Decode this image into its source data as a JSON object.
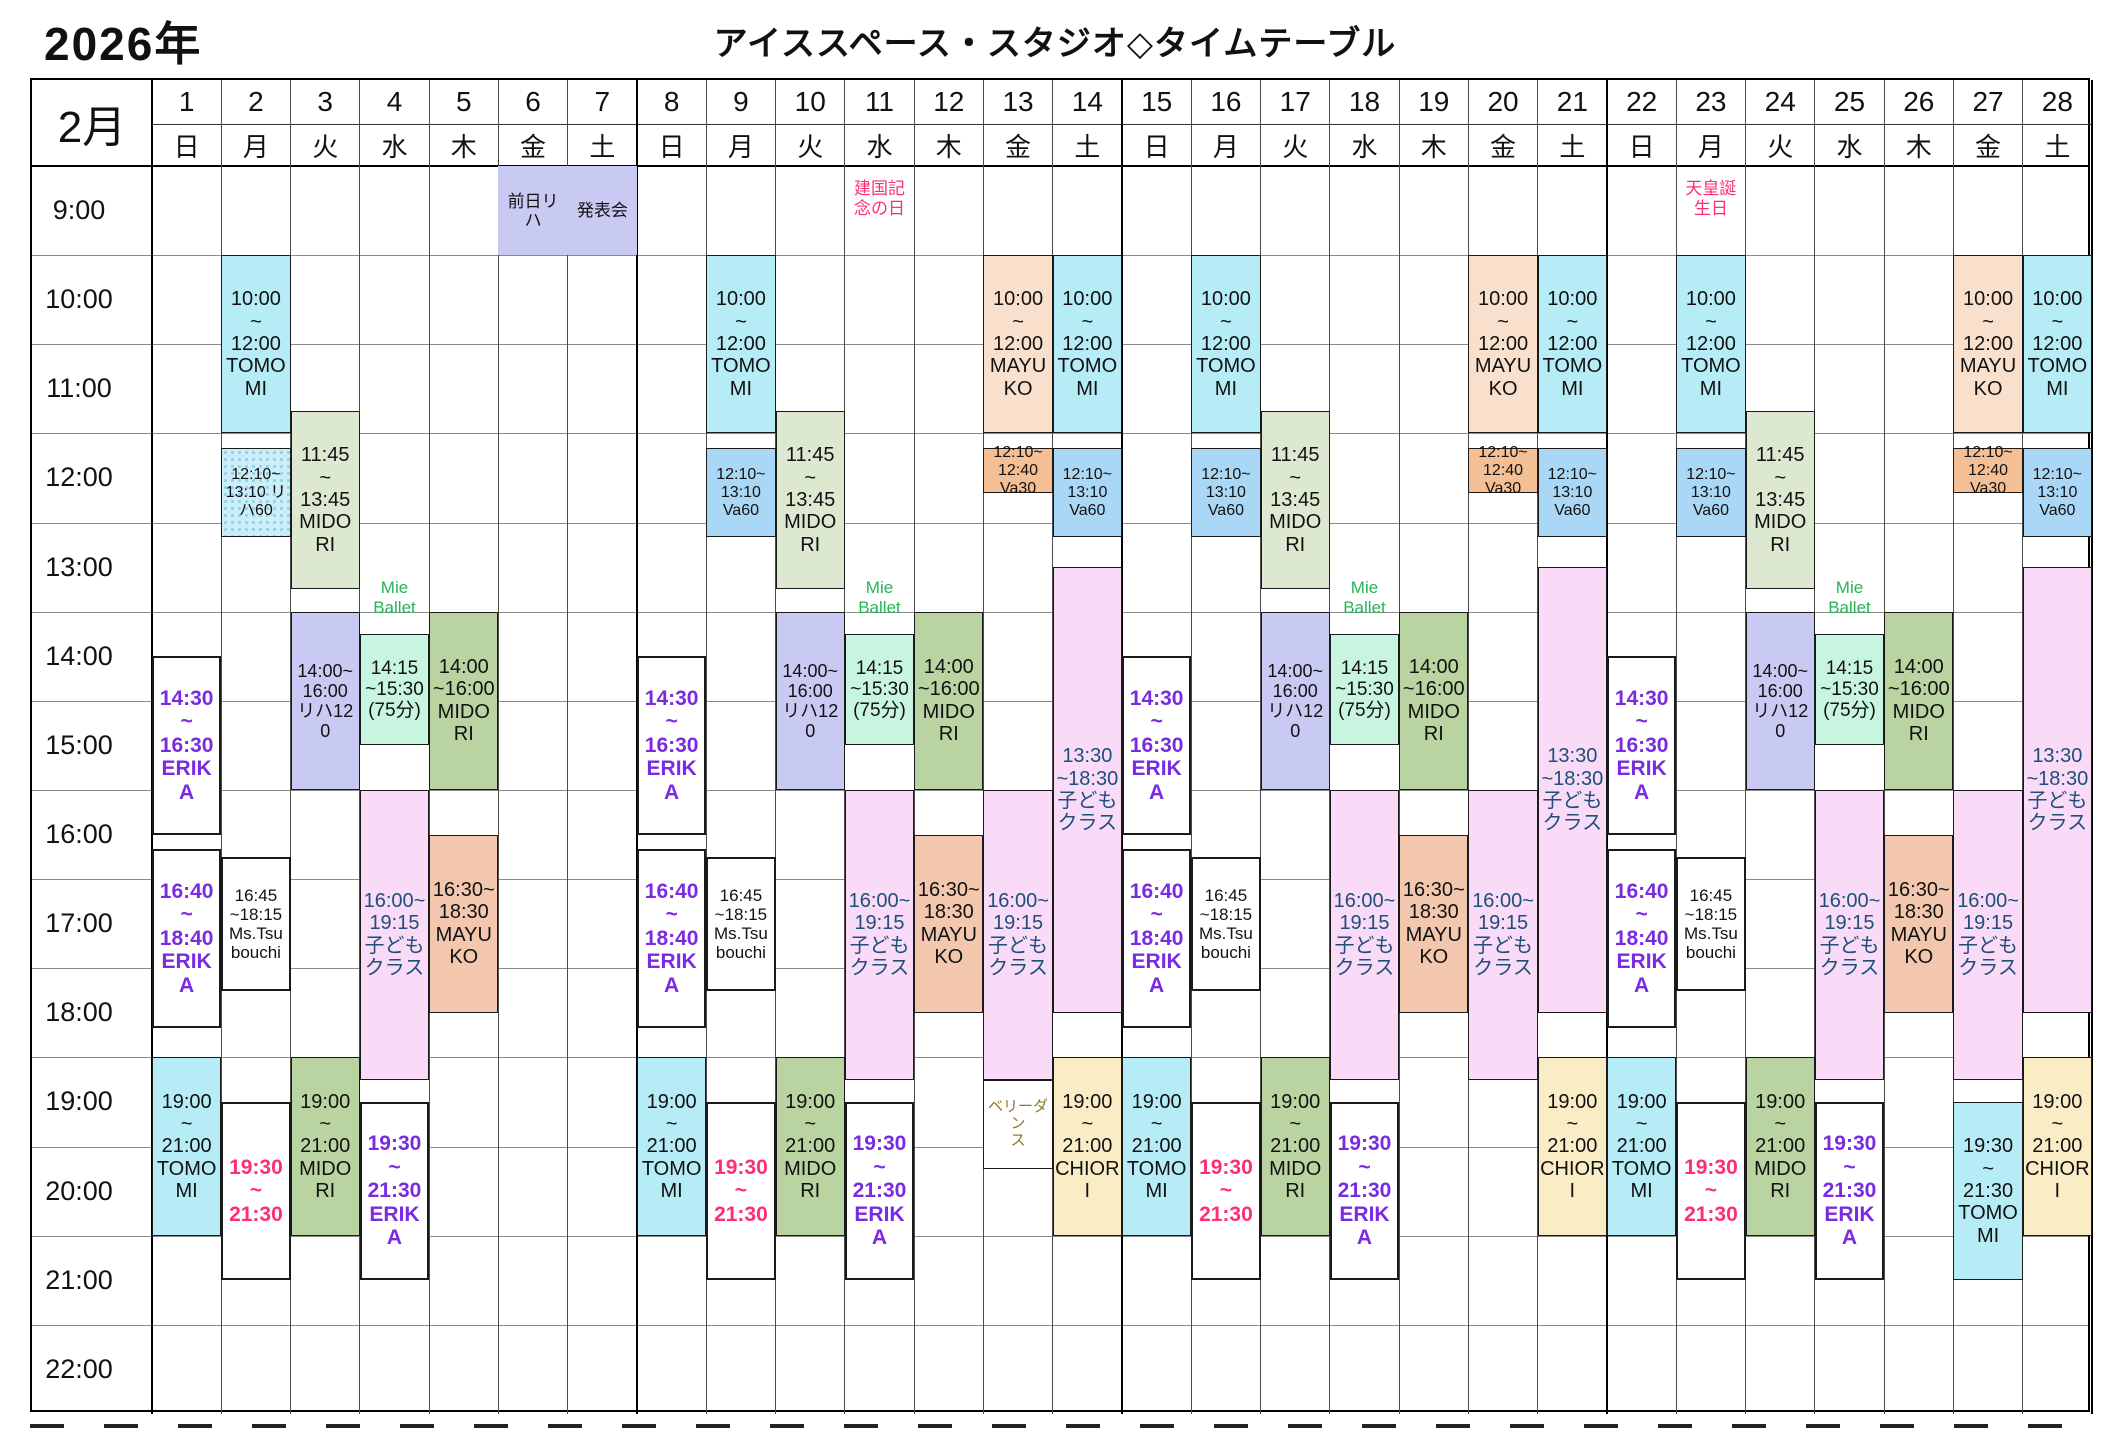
{
  "page": {
    "year_label": "2026年",
    "title": "アイススペース・スタジオ◇タイムテーブル"
  },
  "calendar": {
    "month_label": "2月",
    "time_labels": [
      "9:00",
      "10:00",
      "11:00",
      "12:00",
      "13:00",
      "14:00",
      "15:00",
      "16:00",
      "17:00",
      "18:00",
      "19:00",
      "20:00",
      "21:00",
      "22:00"
    ],
    "days": [
      {
        "num": "1",
        "weekday": "日"
      },
      {
        "num": "2",
        "weekday": "月"
      },
      {
        "num": "3",
        "weekday": "火"
      },
      {
        "num": "4",
        "weekday": "水"
      },
      {
        "num": "5",
        "weekday": "木"
      },
      {
        "num": "6",
        "weekday": "金"
      },
      {
        "num": "7",
        "weekday": "土"
      },
      {
        "num": "8",
        "weekday": "日"
      },
      {
        "num": "9",
        "weekday": "月"
      },
      {
        "num": "10",
        "weekday": "火"
      },
      {
        "num": "11",
        "weekday": "水"
      },
      {
        "num": "12",
        "weekday": "木"
      },
      {
        "num": "13",
        "weekday": "金"
      },
      {
        "num": "14",
        "weekday": "土"
      },
      {
        "num": "15",
        "weekday": "日"
      },
      {
        "num": "16",
        "weekday": "月"
      },
      {
        "num": "17",
        "weekday": "火"
      },
      {
        "num": "18",
        "weekday": "水"
      },
      {
        "num": "19",
        "weekday": "木"
      },
      {
        "num": "20",
        "weekday": "金"
      },
      {
        "num": "21",
        "weekday": "土"
      },
      {
        "num": "22",
        "weekday": "日"
      },
      {
        "num": "23",
        "weekday": "月"
      },
      {
        "num": "24",
        "weekday": "火"
      },
      {
        "num": "25",
        "weekday": "水"
      },
      {
        "num": "26",
        "weekday": "木"
      },
      {
        "num": "27",
        "weekday": "金"
      },
      {
        "num": "28",
        "weekday": "土"
      }
    ],
    "holidays": [
      {
        "day": 11,
        "text": "建国記\n念の日"
      },
      {
        "day": 23,
        "text": "天皇誕\n生日"
      }
    ],
    "floating_labels": [
      {
        "day": 4,
        "text": "Mie\nBallet"
      },
      {
        "day": 11,
        "text": "Mie\nBallet"
      },
      {
        "day": 18,
        "text": "Mie\nBallet"
      },
      {
        "day": 25,
        "text": "Mie\nBallet"
      }
    ],
    "styles": {
      "cyan": {
        "bg": "#b5ecf6",
        "fg": "#111111",
        "borderW": 1.5,
        "size": 20
      },
      "va60": {
        "bg": "#a9d7f5",
        "fg": "#111111",
        "borderW": 1.5,
        "size": 16
      },
      "riha60": {
        "bg": "#cdeef8",
        "fg": "#111111",
        "borderW": 1.5,
        "size": 16,
        "dots": true
      },
      "va30": {
        "bg": "#f4bf95",
        "fg": "#111111",
        "borderW": 1.5,
        "size": 16
      },
      "peach": {
        "bg": "#f9e0cc",
        "fg": "#111111",
        "borderW": 1.5,
        "size": 20
      },
      "salmon": {
        "bg": "#f2c7ad",
        "fg": "#111111",
        "borderW": 1.5,
        "size": 20
      },
      "sage": {
        "bg": "#dde8d1",
        "fg": "#111111",
        "borderW": 1.5,
        "size": 20
      },
      "green": {
        "bg": "#b9d3a1",
        "fg": "#111111",
        "borderW": 1.5,
        "size": 20
      },
      "mint": {
        "bg": "#c8f5df",
        "fg": "#111111",
        "borderW": 1.5,
        "size": 19
      },
      "lavender": {
        "bg": "#c9caf3",
        "fg": "#111111",
        "borderW": 1.5,
        "size": 18
      },
      "lavender_plain": {
        "bg": "#c9caf3",
        "fg": "#111111",
        "borderW": 0,
        "size": 17
      },
      "pink": {
        "bg": "#f9dbf7",
        "fg": "#1e4e79",
        "borderW": 1.5,
        "size": 20
      },
      "cream": {
        "bg": "#faecc5",
        "fg": "#111111",
        "borderW": 1.5,
        "size": 20
      },
      "white_purple": {
        "bg": "#ffffff",
        "fg": "#7a2be2",
        "borderW": 2,
        "size": 21,
        "bold": true
      },
      "white_red": {
        "bg": "#ffffff",
        "fg": "#ff2d78",
        "borderW": 2,
        "size": 21,
        "bold": true
      },
      "white_black": {
        "bg": "#ffffff",
        "fg": "#111111",
        "borderW": 2,
        "size": 17
      },
      "white_gold": {
        "bg": "#ffffff",
        "fg": "#8f7a1c",
        "borderW": 1.5,
        "size": 15
      }
    },
    "holiday_color": "#ff2d78",
    "floating_label_color": "#27b357",
    "events": [
      {
        "day": 1,
        "start": 14.5,
        "end": 16.5,
        "style": "white_purple",
        "text": "14:30\n~\n16:30\nERIKA"
      },
      {
        "day": 1,
        "start": 16.667,
        "end": 18.667,
        "style": "white_purple",
        "text": "16:40\n~\n18:40\nERIKA"
      },
      {
        "day": 1,
        "start": 19,
        "end": 21,
        "style": "cyan",
        "text": "19:00\n~\n21:00\nTOMO\nMI"
      },
      {
        "day": 2,
        "start": 10,
        "end": 12,
        "style": "cyan",
        "text": "10:00\n~\n12:00\nTOMO\nMI"
      },
      {
        "day": 2,
        "start": 12.167,
        "end": 13.167,
        "style": "riha60",
        "text": "12:10~\n13:10 リハ60"
      },
      {
        "day": 2,
        "start": 16.75,
        "end": 18.25,
        "style": "white_black",
        "text": "16:45\n~18:15\nMs.Tsu\nbouchi"
      },
      {
        "day": 2,
        "start": 19.5,
        "end": 21.5,
        "style": "white_red",
        "text": "19:30\n~\n21:30"
      },
      {
        "day": 3,
        "start": 11.75,
        "end": 13.75,
        "style": "sage",
        "text": "11:45\n~\n13:45\nMIDO\nRI"
      },
      {
        "day": 3,
        "start": 14,
        "end": 16,
        "style": "lavender",
        "text": "14:00~\n16:00\nリハ120"
      },
      {
        "day": 3,
        "start": 19,
        "end": 21,
        "style": "green",
        "text": "19:00\n~\n21:00\nMIDO\nRI"
      },
      {
        "day": 4,
        "start": 14.25,
        "end": 15.5,
        "style": "mint",
        "text": "14:15\n~15:30(75分)"
      },
      {
        "day": 4,
        "start": 16,
        "end": 19.25,
        "style": "pink",
        "text": "16:00~\n19:15\n子ども\nクラス"
      },
      {
        "day": 4,
        "start": 19.5,
        "end": 21.5,
        "style": "white_purple",
        "text": "19:30\n~\n21:30\nERIK\nA"
      },
      {
        "day": 5,
        "start": 14,
        "end": 16,
        "style": "green",
        "text": "14:00\n~16:00\nMIDO\nRI"
      },
      {
        "day": 5,
        "start": 16.5,
        "end": 18.5,
        "style": "salmon",
        "text": "16:30~\n18:30\nMAYU\nKO"
      },
      {
        "day": 6,
        "start": 9,
        "end": 10,
        "style": "lavender_plain",
        "text": "前日リ\nハ"
      },
      {
        "day": 7,
        "start": 9,
        "end": 10,
        "style": "lavender_plain",
        "text": "発表会"
      },
      {
        "day": 8,
        "start": 14.5,
        "end": 16.5,
        "style": "white_purple",
        "text": "14:30\n~\n16:30\nERIKA"
      },
      {
        "day": 8,
        "start": 16.667,
        "end": 18.667,
        "style": "white_purple",
        "text": "16:40\n~\n18:40\nERIKA"
      },
      {
        "day": 8,
        "start": 19,
        "end": 21,
        "style": "cyan",
        "text": "19:00\n~\n21:00\nTOMO\nMI"
      },
      {
        "day": 9,
        "start": 10,
        "end": 12,
        "style": "cyan",
        "text": "10:00\n~\n12:00\nTOMO\nMI"
      },
      {
        "day": 9,
        "start": 12.167,
        "end": 13.167,
        "style": "va60",
        "text": "12:10~\n13:10\nVa60"
      },
      {
        "day": 9,
        "start": 16.75,
        "end": 18.25,
        "style": "white_black",
        "text": "16:45\n~18:15\nMs.Tsu\nbouchi"
      },
      {
        "day": 9,
        "start": 19.5,
        "end": 21.5,
        "style": "white_red",
        "text": "19:30\n~\n21:30"
      },
      {
        "day": 10,
        "start": 11.75,
        "end": 13.75,
        "style": "sage",
        "text": "11:45\n~\n13:45\nMIDO\nRI"
      },
      {
        "day": 10,
        "start": 14,
        "end": 16,
        "style": "lavender",
        "text": "14:00~\n16:00\nリハ120"
      },
      {
        "day": 10,
        "start": 19,
        "end": 21,
        "style": "green",
        "text": "19:00\n~\n21:00\nMIDO\nRI"
      },
      {
        "day": 11,
        "start": 14.25,
        "end": 15.5,
        "style": "mint",
        "text": "14:15\n~15:30(75分)"
      },
      {
        "day": 11,
        "start": 16,
        "end": 19.25,
        "style": "pink",
        "text": "16:00~\n19:15\n子ども\nクラス"
      },
      {
        "day": 11,
        "start": 19.5,
        "end": 21.5,
        "style": "white_purple",
        "text": "19:30\n~\n21:30\nERIK\nA"
      },
      {
        "day": 12,
        "start": 14,
        "end": 16,
        "style": "green",
        "text": "14:00\n~16:00\nMIDO\nRI"
      },
      {
        "day": 12,
        "start": 16.5,
        "end": 18.5,
        "style": "salmon",
        "text": "16:30~\n18:30\nMAYU\nKO"
      },
      {
        "day": 13,
        "start": 10,
        "end": 12,
        "style": "peach",
        "text": "10:00\n~\n12:00\nMAYU\nKO"
      },
      {
        "day": 13,
        "start": 12.167,
        "end": 12.667,
        "style": "va30",
        "text": "12:10~\n12:40\nVa30"
      },
      {
        "day": 13,
        "start": 16,
        "end": 19.25,
        "style": "pink",
        "text": "16:00~\n19:15\n子ども\nクラス"
      },
      {
        "day": 13,
        "start": 19.25,
        "end": 20.25,
        "style": "white_gold",
        "text": "ベリーダン\nス"
      },
      {
        "day": 14,
        "start": 10,
        "end": 12,
        "style": "cyan",
        "text": "10:00\n~\n12:00\nTOMO\nMI"
      },
      {
        "day": 14,
        "start": 12.167,
        "end": 13.167,
        "style": "va60",
        "text": "12:10~\n13:10\nVa60"
      },
      {
        "day": 14,
        "start": 13.5,
        "end": 18.5,
        "style": "pink",
        "text": "13:30\n~18:30 子どもクラス"
      },
      {
        "day": 14,
        "start": 19,
        "end": 21,
        "style": "cream",
        "text": "19:00\n~\n21:00\nCHIOR\nI"
      },
      {
        "day": 15,
        "start": 14.5,
        "end": 16.5,
        "style": "white_purple",
        "text": "14:30\n~\n16:30\nERIKA"
      },
      {
        "day": 15,
        "start": 16.667,
        "end": 18.667,
        "style": "white_purple",
        "text": "16:40\n~\n18:40\nERIKA"
      },
      {
        "day": 15,
        "start": 19,
        "end": 21,
        "style": "cyan",
        "text": "19:00\n~\n21:00\nTOMO\nMI"
      },
      {
        "day": 16,
        "start": 10,
        "end": 12,
        "style": "cyan",
        "text": "10:00\n~\n12:00\nTOMO\nMI"
      },
      {
        "day": 16,
        "start": 12.167,
        "end": 13.167,
        "style": "va60",
        "text": "12:10~\n13:10\nVa60"
      },
      {
        "day": 16,
        "start": 16.75,
        "end": 18.25,
        "style": "white_black",
        "text": "16:45\n~18:15\nMs.Tsu\nbouchi"
      },
      {
        "day": 16,
        "start": 19.5,
        "end": 21.5,
        "style": "white_red",
        "text": "19:30\n~\n21:30"
      },
      {
        "day": 17,
        "start": 11.75,
        "end": 13.75,
        "style": "sage",
        "text": "11:45\n~\n13:45\nMIDO\nRI"
      },
      {
        "day": 17,
        "start": 14,
        "end": 16,
        "style": "lavender",
        "text": "14:00~\n16:00\nリハ120"
      },
      {
        "day": 17,
        "start": 19,
        "end": 21,
        "style": "green",
        "text": "19:00\n~\n21:00\nMIDO\nRI"
      },
      {
        "day": 18,
        "start": 14.25,
        "end": 15.5,
        "style": "mint",
        "text": "14:15\n~15:30(75分)"
      },
      {
        "day": 18,
        "start": 16,
        "end": 19.25,
        "style": "pink",
        "text": "16:00~\n19:15\n子ども\nクラス"
      },
      {
        "day": 18,
        "start": 19.5,
        "end": 21.5,
        "style": "white_purple",
        "text": "19:30\n~\n21:30\nERIK\nA"
      },
      {
        "day": 19,
        "start": 14,
        "end": 16,
        "style": "green",
        "text": "14:00\n~16:00\nMIDO\nRI"
      },
      {
        "day": 19,
        "start": 16.5,
        "end": 18.5,
        "style": "salmon",
        "text": "16:30~\n18:30\nMAYU\nKO"
      },
      {
        "day": 20,
        "start": 10,
        "end": 12,
        "style": "peach",
        "text": "10:00\n~\n12:00\nMAYU\nKO"
      },
      {
        "day": 20,
        "start": 12.167,
        "end": 12.667,
        "style": "va30",
        "text": "12:10~\n12:40\nVa30"
      },
      {
        "day": 20,
        "start": 16,
        "end": 19.25,
        "style": "pink",
        "text": "16:00~\n19:15\n子ども\nクラス"
      },
      {
        "day": 21,
        "start": 10,
        "end": 12,
        "style": "cyan",
        "text": "10:00\n~\n12:00\nTOMO\nMI"
      },
      {
        "day": 21,
        "start": 12.167,
        "end": 13.167,
        "style": "va60",
        "text": "12:10~\n13:10\nVa60"
      },
      {
        "day": 21,
        "start": 13.5,
        "end": 18.5,
        "style": "pink",
        "text": "13:30\n~18:30 子どもクラス"
      },
      {
        "day": 21,
        "start": 19,
        "end": 21,
        "style": "cream",
        "text": "19:00\n~\n21:00\nCHIOR\nI"
      },
      {
        "day": 22,
        "start": 14.5,
        "end": 16.5,
        "style": "white_purple",
        "text": "14:30\n~\n16:30\nERIKA"
      },
      {
        "day": 22,
        "start": 16.667,
        "end": 18.667,
        "style": "white_purple",
        "text": "16:40\n~\n18:40\nERIKA"
      },
      {
        "day": 22,
        "start": 19,
        "end": 21,
        "style": "cyan",
        "text": "19:00\n~\n21:00\nTOMO\nMI"
      },
      {
        "day": 23,
        "start": 10,
        "end": 12,
        "style": "cyan",
        "text": "10:00\n~\n12:00\nTOMO\nMI"
      },
      {
        "day": 23,
        "start": 12.167,
        "end": 13.167,
        "style": "va60",
        "text": "12:10~\n13:10\nVa60"
      },
      {
        "day": 23,
        "start": 16.75,
        "end": 18.25,
        "style": "white_black",
        "text": "16:45\n~18:15\nMs.Tsu\nbouchi"
      },
      {
        "day": 23,
        "start": 19.5,
        "end": 21.5,
        "style": "white_red",
        "text": "19:30\n~\n21:30"
      },
      {
        "day": 24,
        "start": 11.75,
        "end": 13.75,
        "style": "sage",
        "text": "11:45\n~\n13:45\nMIDO\nRI"
      },
      {
        "day": 24,
        "start": 14,
        "end": 16,
        "style": "lavender",
        "text": "14:00~\n16:00\nリハ120"
      },
      {
        "day": 24,
        "start": 19,
        "end": 21,
        "style": "green",
        "text": "19:00\n~\n21:00\nMIDO\nRI"
      },
      {
        "day": 25,
        "start": 14.25,
        "end": 15.5,
        "style": "mint",
        "text": "14:15\n~15:30(75分)"
      },
      {
        "day": 25,
        "start": 16,
        "end": 19.25,
        "style": "pink",
        "text": "16:00~\n19:15\n子ども\nクラス"
      },
      {
        "day": 25,
        "start": 19.5,
        "end": 21.5,
        "style": "white_purple",
        "text": "19:30\n~\n21:30\nERIK\nA"
      },
      {
        "day": 26,
        "start": 14,
        "end": 16,
        "style": "green",
        "text": "14:00\n~16:00\nMIDO\nRI"
      },
      {
        "day": 26,
        "start": 16.5,
        "end": 18.5,
        "style": "salmon",
        "text": "16:30~\n18:30\nMAYU\nKO"
      },
      {
        "day": 27,
        "start": 10,
        "end": 12,
        "style": "peach",
        "text": "10:00\n~\n12:00\nMAYU\nKO"
      },
      {
        "day": 27,
        "start": 12.167,
        "end": 12.667,
        "style": "va30",
        "text": "12:10~\n12:40\nVa30"
      },
      {
        "day": 27,
        "start": 16,
        "end": 19.25,
        "style": "pink",
        "text": "16:00~\n19:15\n子ども\nクラス"
      },
      {
        "day": 27,
        "start": 19.5,
        "end": 21.5,
        "style": "cyan",
        "text": "19:30\n~\n21:30\nTOMO\nMI"
      },
      {
        "day": 28,
        "start": 10,
        "end": 12,
        "style": "cyan",
        "text": "10:00\n~\n12:00\nTOMO\nMI"
      },
      {
        "day": 28,
        "start": 12.167,
        "end": 13.167,
        "style": "va60",
        "text": "12:10~\n13:10\nVa60"
      },
      {
        "day": 28,
        "start": 13.5,
        "end": 18.5,
        "style": "pink",
        "text": "13:30\n~18:30 子どもクラス"
      },
      {
        "day": 28,
        "start": 19,
        "end": 21,
        "style": "cream",
        "text": "19:00\n~\n21:00\nCHIOR\nI"
      }
    ]
  }
}
